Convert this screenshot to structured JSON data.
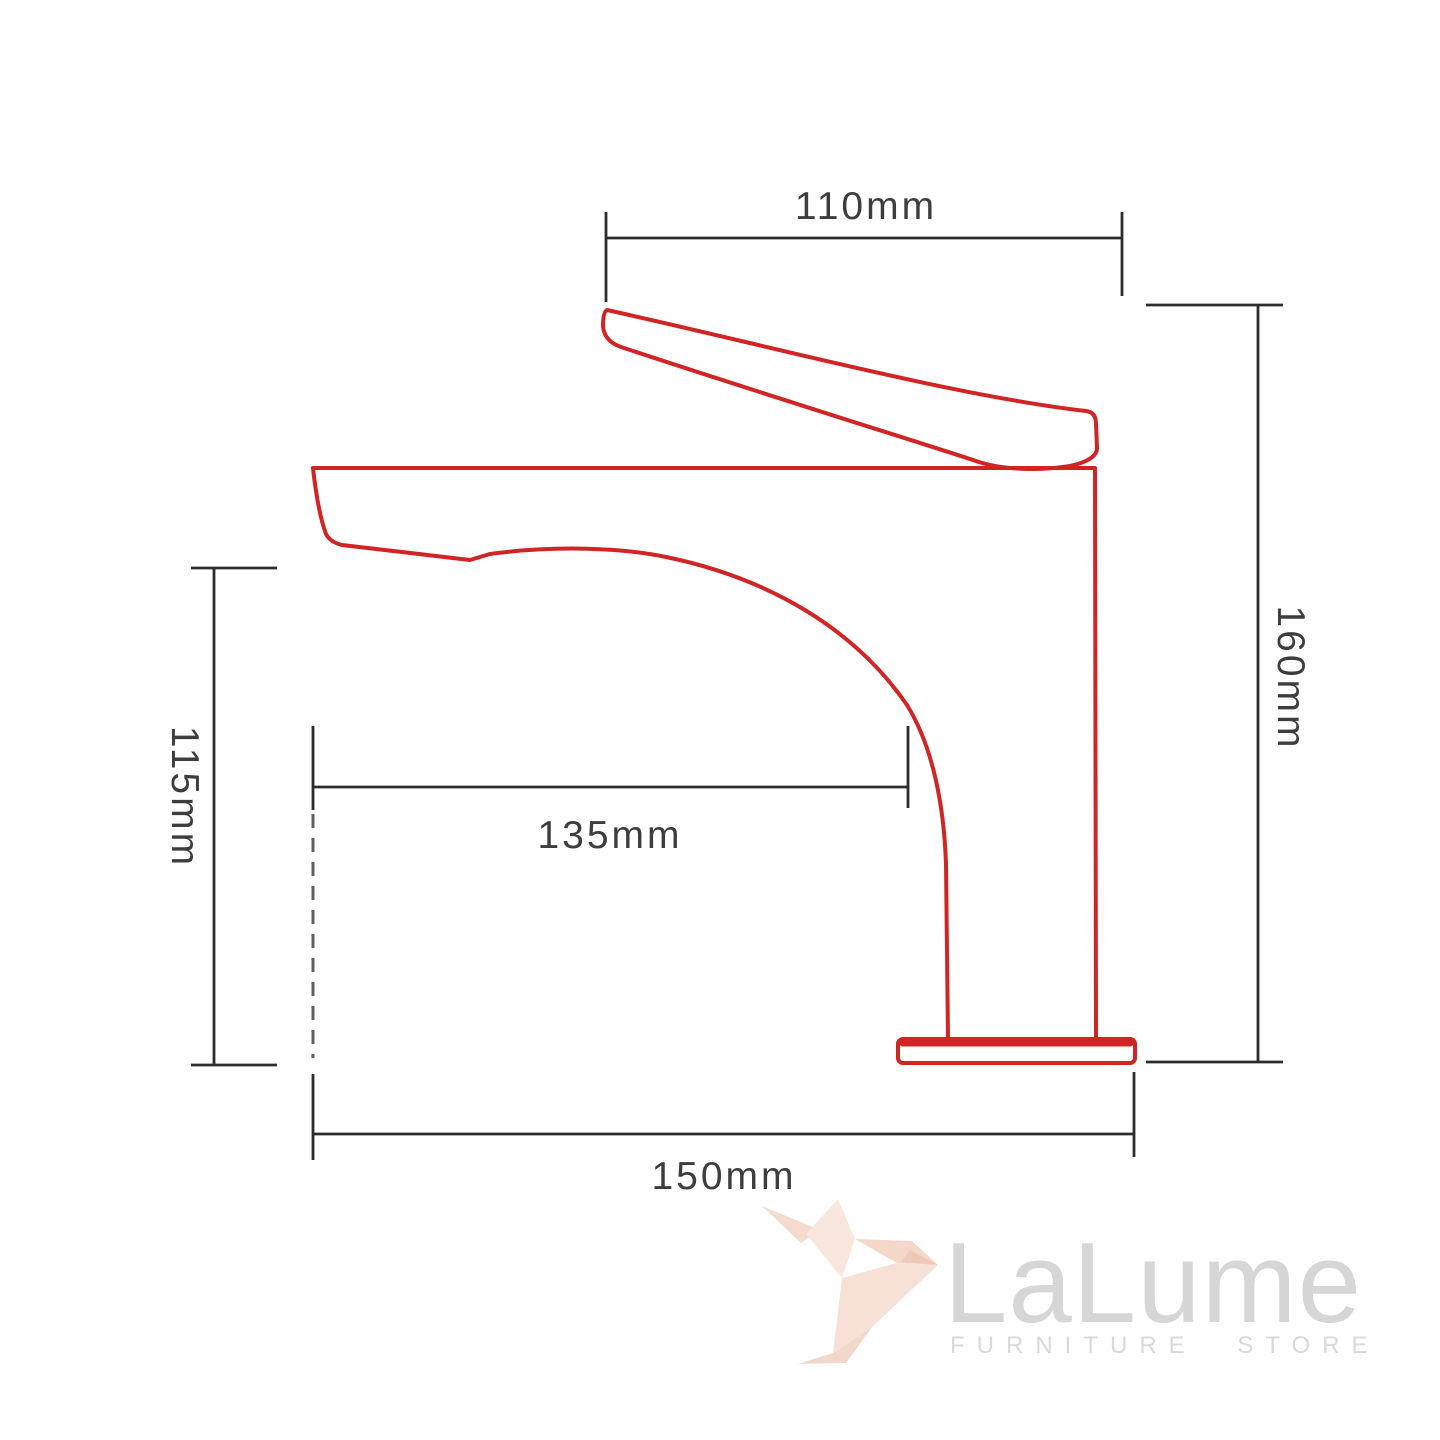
{
  "canvas": {
    "background": "#ffffff",
    "width": 1440,
    "height": 1440
  },
  "drawing": {
    "subject": "single-handle basin faucet side-profile technical drawing",
    "outline_color": "#d12424",
    "dimension_line_color": "#2d2d2d",
    "dashed_line_color": "#5f5f5f",
    "label_color": "#3d3d3d",
    "dimensions": [
      {
        "id": "handle-length",
        "label": "110mm",
        "orientation": "horizontal",
        "position": "top"
      },
      {
        "id": "overall-height",
        "label": "160mm",
        "orientation": "vertical",
        "position": "right"
      },
      {
        "id": "spout-clearance",
        "label": "115mm",
        "orientation": "vertical",
        "position": "left"
      },
      {
        "id": "spout-reach",
        "label": "135mm",
        "orientation": "horizontal",
        "position": "center"
      },
      {
        "id": "overall-depth",
        "label": "150mm",
        "orientation": "horizontal",
        "position": "bottom"
      }
    ]
  },
  "watermark": {
    "brand": "LaLume",
    "tagline": "FURNITURE STORE",
    "brand_color": "#d6d6d6",
    "tagline_color": "#d9d9d9",
    "bird_icon": "origami-hummingbird-icon",
    "bird_color": "#f7e1d6"
  }
}
